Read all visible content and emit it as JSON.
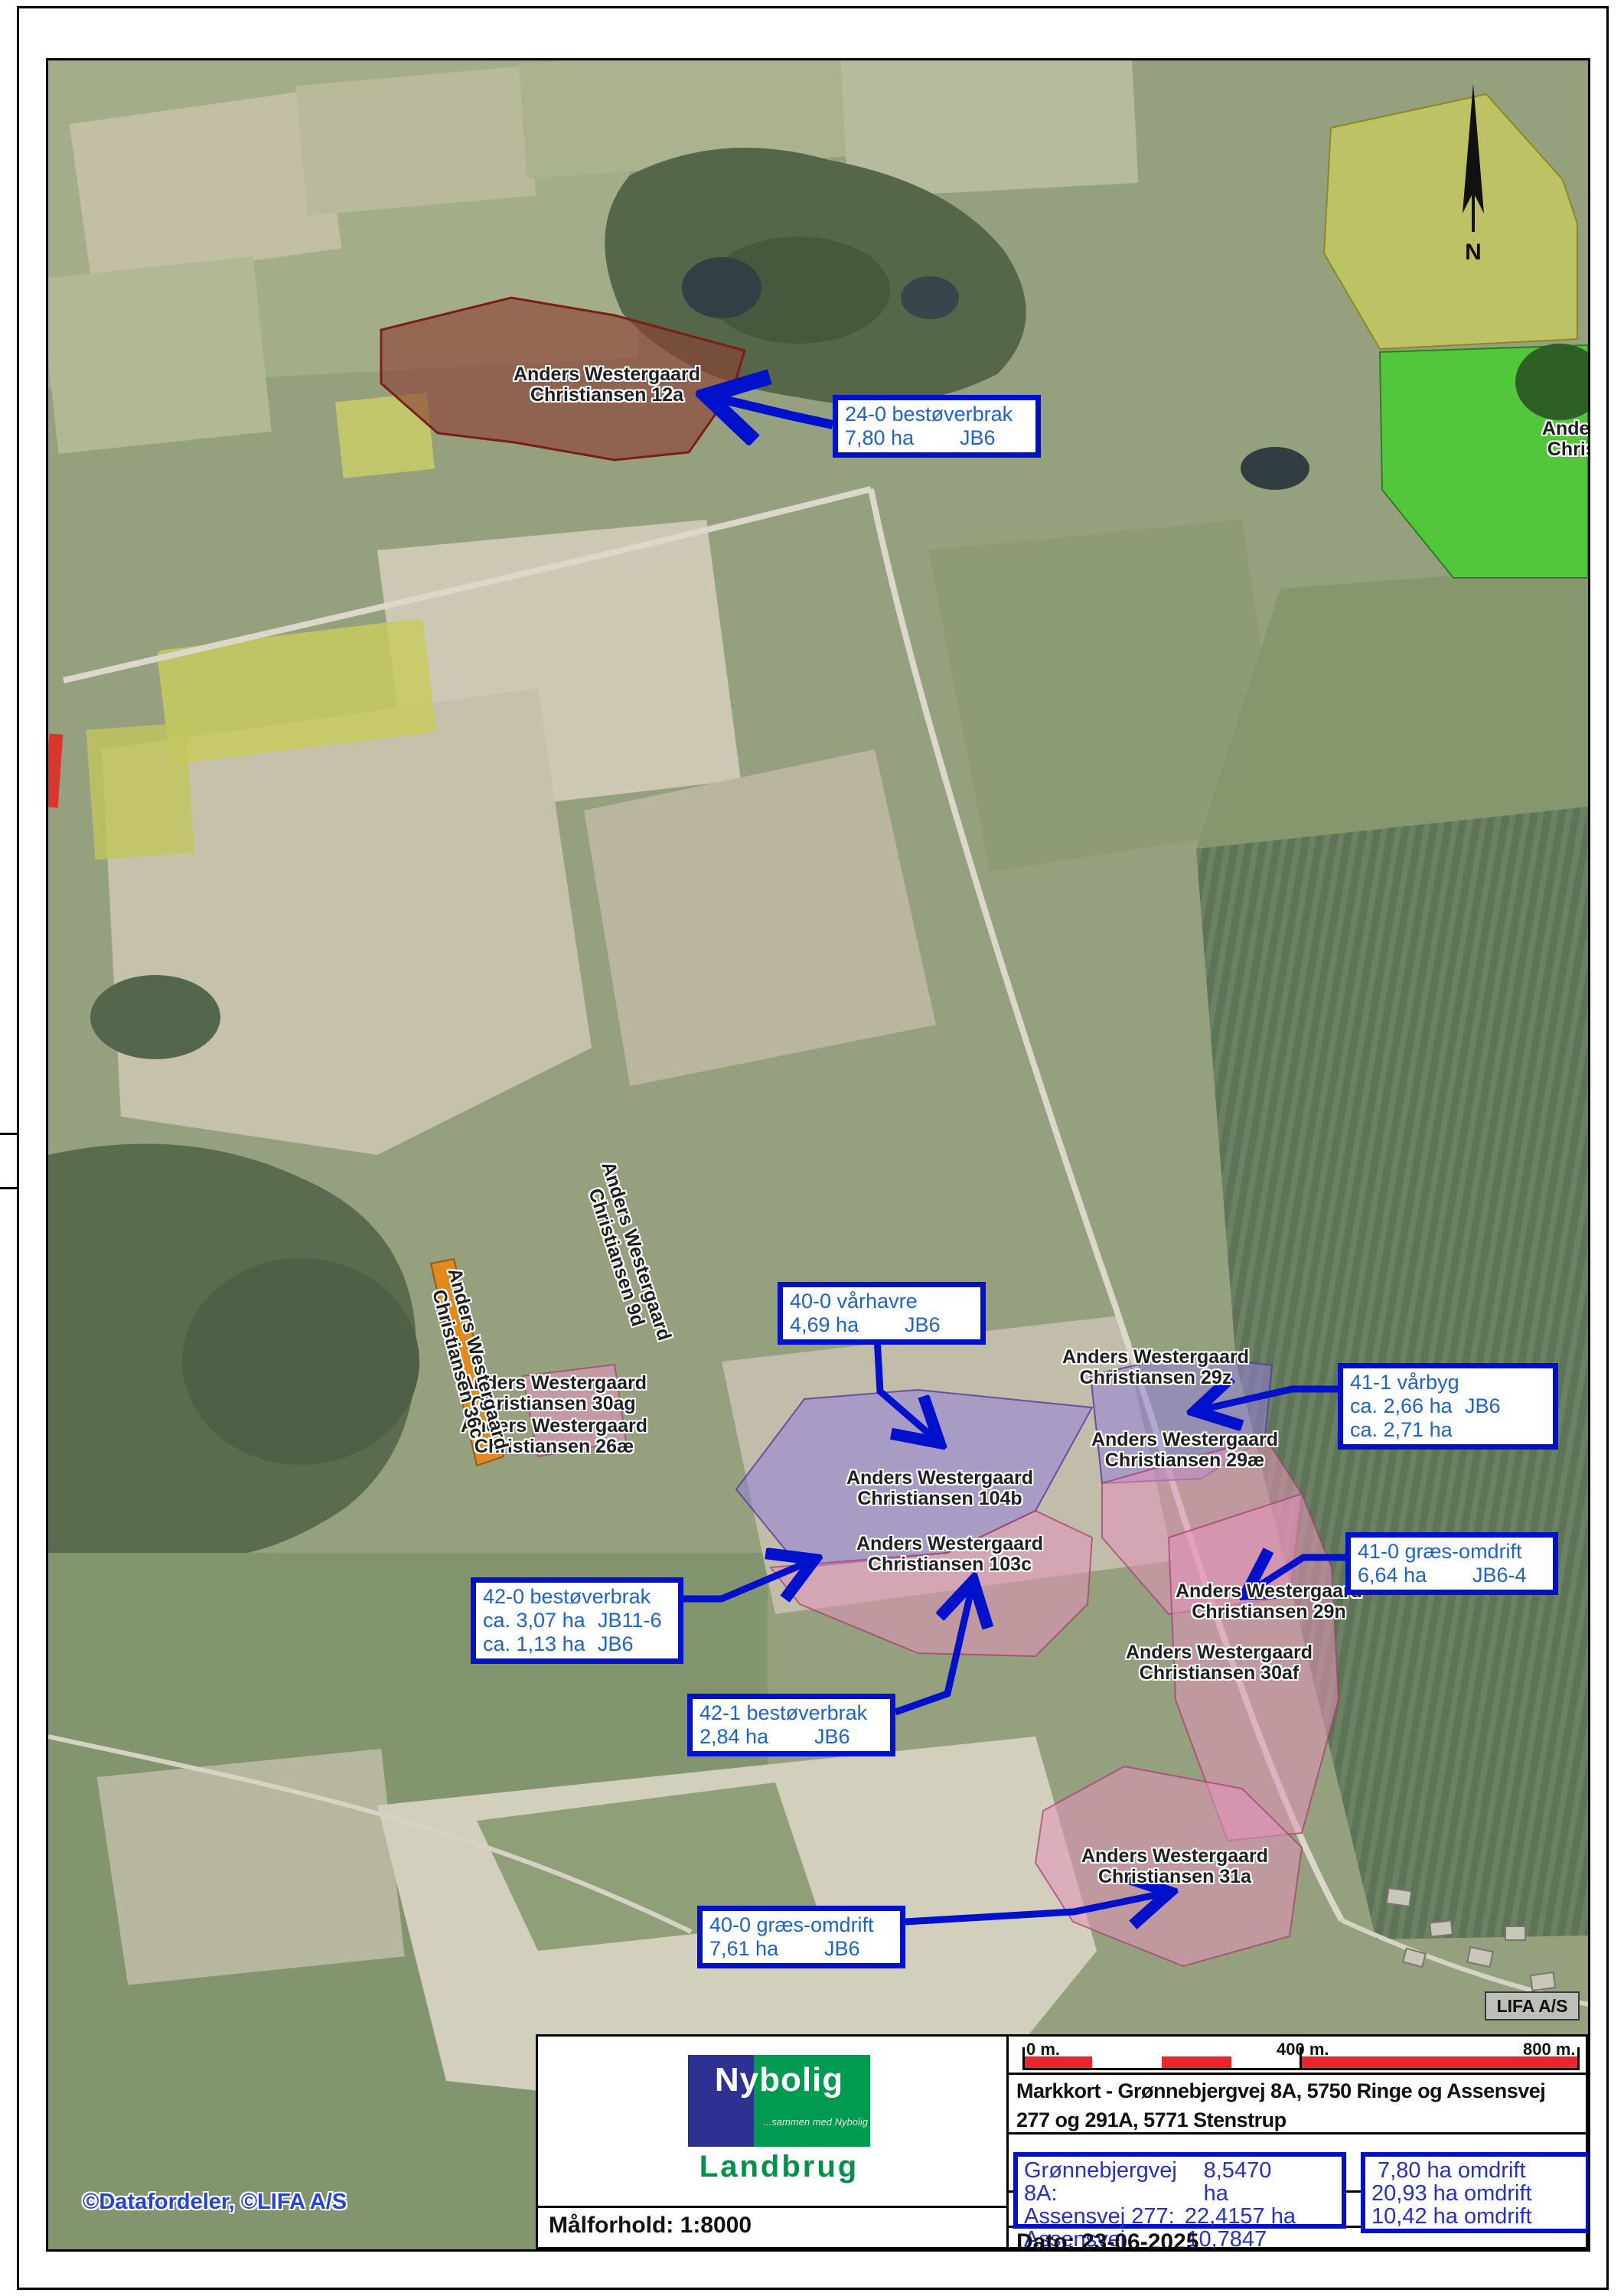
{
  "map": {
    "attribution": "©Datafordeler, ©LIFA A/S",
    "lifa_badge": "LIFA A/S",
    "north_label": "N",
    "colors": {
      "callout_border": "#0011cc",
      "callout_text": "#1c62d4",
      "footer_box_border": "#0011cc",
      "footer_box_text": "#2330cf",
      "scale_bar_red": "#e8262c",
      "overlay_purple": "#9480d8",
      "overlay_pink": "#e494b9",
      "overlay_brown": "#8c3e34",
      "overlay_green": "#53c73b",
      "overlay_yellow": "#dede50",
      "overlay_orange": "#e08a1e",
      "nybolig_navy": "#2e3192",
      "nybolig_green": "#009a51"
    }
  },
  "field_labels": [
    {
      "line1": "Anders Westergaard",
      "line2": "Christiansen 12a"
    },
    {
      "line1": "Anders Westergaard",
      "line2": "Christiansen 104b"
    },
    {
      "line1": "Anders Westergaard",
      "line2": "Christiansen 103c"
    },
    {
      "line1": "Anders Westergaard",
      "line2": "Christiansen 29z"
    },
    {
      "line1": "Anders Westergaard",
      "line2": "Christiansen 29æ"
    },
    {
      "line1": "Anders Westergaard",
      "line2": "Christiansen 29n"
    },
    {
      "line1": "Anders Westergaard",
      "line2": "Christiansen 30af"
    },
    {
      "line1": "Anders Westergaard",
      "line2": "Christiansen 31a"
    },
    {
      "line1": "Anders Westergaard",
      "line2": "Christiansen 30ag"
    },
    {
      "line1": "Anders Westergaard",
      "line2": "Christiansen 26æ"
    },
    {
      "line1": "Anders Westergaard",
      "line2": "Christiansen 36c"
    },
    {
      "line1": "Anders Westergaard",
      "line2": "Christiansen 9d"
    },
    {
      "line1": "Anders",
      "line2": "Christ"
    }
  ],
  "callouts": [
    {
      "title": "24-0 bestøverbrak",
      "rows": [
        {
          "l": "7,80 ha",
          "r": "JB6"
        }
      ]
    },
    {
      "title": "40-0 vårhavre",
      "rows": [
        {
          "l": "4,69 ha",
          "r": "JB6"
        }
      ]
    },
    {
      "title": "41-1 vårbyg",
      "rows": [
        {
          "l": "ca. 2,66 ha",
          "r": "JB6"
        },
        {
          "l": "ca. 2,71 ha",
          "r": ""
        }
      ]
    },
    {
      "title": "42-0 bestøverbrak",
      "rows": [
        {
          "l": "ca. 3,07 ha",
          "r": "JB11-6"
        },
        {
          "l": "ca. 1,13 ha",
          "r": "JB6"
        }
      ]
    },
    {
      "title": "41-0 græs-omdrift",
      "rows": [
        {
          "l": "6,64 ha",
          "r": "JB6-4"
        }
      ]
    },
    {
      "title": "42-1 bestøverbrak",
      "rows": [
        {
          "l": "2,84 ha",
          "r": "JB6"
        }
      ]
    },
    {
      "title": "40-0 græs-omdrift",
      "rows": [
        {
          "l": "7,61 ha",
          "r": "JB6"
        }
      ]
    }
  ],
  "footer": {
    "logo": {
      "brand": "Nybolig",
      "tagline": "...sammen med Nybolig",
      "division": "Landbrug"
    },
    "scale_bar": {
      "start": "0 m.",
      "mid": "400 m.",
      "end": "800 m."
    },
    "title_line1": "Markkort - Grønnebjergvej 8A, 5750 Ringe og Assensvej",
    "title_line2": "277 og 291A, 5771 Stenstrup",
    "areas": [
      {
        "label": "Grønnebjergvej 8A:",
        "value": "8,5470 ha"
      },
      {
        "label": "Assensvej 277:",
        "value": "22,4157 ha"
      },
      {
        "label": "Assensvej 291A:",
        "value": "10,7847 ha"
      }
    ],
    "omdrift": [
      {
        "text": " 7,80 ha omdrift"
      },
      {
        "text": "20,93 ha omdrift"
      },
      {
        "text": "10,42 ha omdrift"
      }
    ],
    "scale_label": "Målforhold: 1:8000",
    "date_label": "Dato: 23-06-2025"
  }
}
